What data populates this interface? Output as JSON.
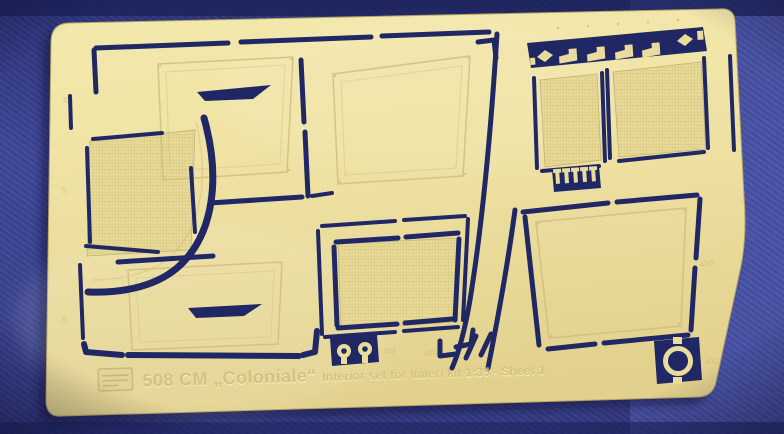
{
  "caption": {
    "set_number": "508 CM ",
    "set_name": "„Coloniale“ ",
    "set_info": "Interior set for Italeri kit 1:35 - Sheet 1"
  },
  "etched_numbers": {
    "left_top": "4",
    "left_mid": "5",
    "left_bottom": "6",
    "eyelet_part": "403",
    "center_mark": "420",
    "right_panel": "410",
    "ring_part": "400"
  },
  "colors": {
    "fabric_blue": "#3e4794",
    "fabric_blue_light": "#4c56a8",
    "fabric_blue_dark": "#272e6d",
    "brass": "#eee1a3",
    "brass_deep": "#dcca8a",
    "cut_navy": "#1f2765",
    "etch_line": "#d0bd7e"
  }
}
